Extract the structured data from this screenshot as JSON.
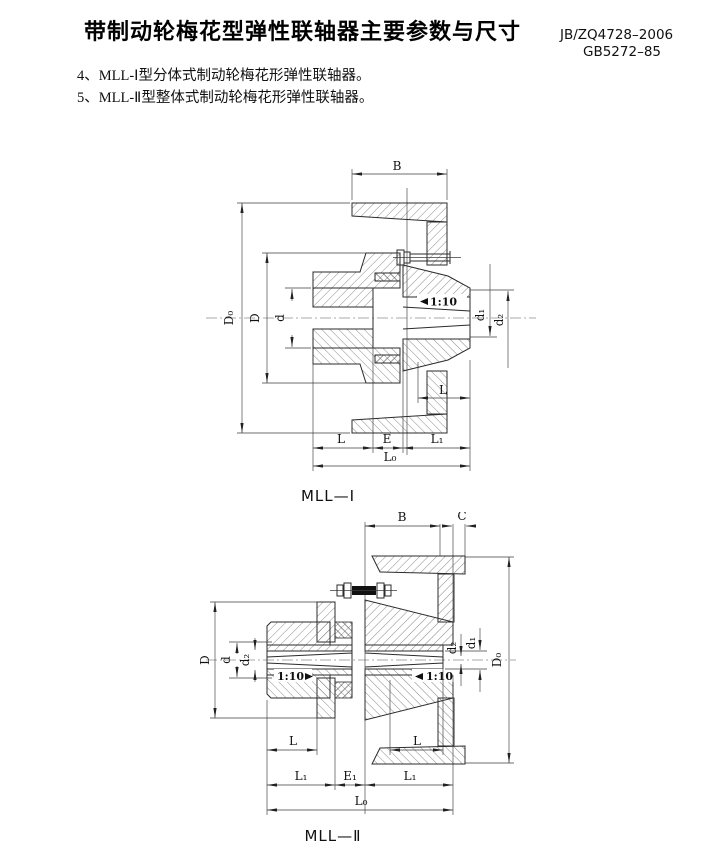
{
  "header": {
    "title": "带制动轮梅花型弹性联轴器主要参数与尺寸",
    "standard1": "JB/ZQ4728–2006",
    "standard2": "GB5272–85",
    "note1": "4、MLL-Ⅰ型分体式制动轮梅花形弹性联轴器。",
    "note2": "5、MLL-Ⅱ型整体式制动轮梅花形弹性联轴器。"
  },
  "figure1": {
    "caption": "MLL—Ⅰ",
    "labels": {
      "B": "B",
      "D0": "D₀",
      "D": "D",
      "d": "d",
      "taper": "1:10",
      "d1": "d₁",
      "d2": "d₂",
      "L_hub": "L",
      "L": "L",
      "E": "E",
      "L1": "L₁",
      "L0": "L₀"
    }
  },
  "figure2": {
    "caption": "MLL—Ⅱ",
    "labels": {
      "B": "B",
      "C": "C",
      "D": "D",
      "d": "d",
      "d2_left": "d₂",
      "taper_left": "1:10",
      "taper_right": "1:10",
      "d2_right": "d₂",
      "d1": "d₁",
      "D0": "D₀",
      "L_left": "L",
      "L_right": "L",
      "L1_left": "L₁",
      "E1": "E₁",
      "L1_right": "L₁",
      "L0": "L₀"
    }
  }
}
